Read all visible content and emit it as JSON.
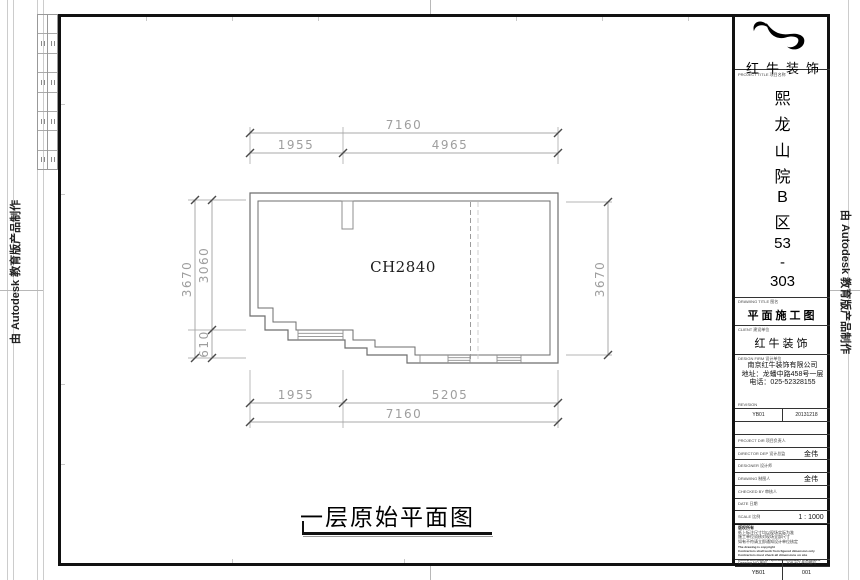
{
  "page": {
    "edge_stamp": "由 Autodesk 教育版产品制作"
  },
  "plan": {
    "room_label": "CH2840",
    "caption": "一层原始平面图",
    "dims": {
      "top_total": "7160",
      "top_left": "1955",
      "top_right": "4965",
      "bottom_left": "1955",
      "bottom_right": "5205",
      "bottom_total": "7160",
      "left_total": "3670",
      "left_upper": "3060",
      "left_lower": "610",
      "right_total": "3670"
    }
  },
  "titleblock": {
    "logo_name": "红牛装饰",
    "logo_sublabel": "PROJECT TITLE 项目名称",
    "project_chars": [
      "熙",
      "龙",
      "山",
      "院",
      "B",
      "区",
      "53",
      "-",
      "303"
    ],
    "drawing_title": {
      "label": "DRAWING TITLE 图名",
      "value": "平面施工图"
    },
    "client": {
      "label": "CLIENT 建设单位",
      "value": "红牛装饰"
    },
    "firm": {
      "label": "DESIGN FIRM 设计单位",
      "line1": "南京红牛装饰有限公司",
      "line2": "地址：龙蟠中路458号一层",
      "line3": "电话：025-52328155",
      "revision_label": "REVISION"
    },
    "revision_row": {
      "code": "YB01",
      "date": "20131218"
    },
    "personnel": [
      {
        "label": "PROJECT DIR 项目负责人",
        "value": ""
      },
      {
        "label": "DIRECTOR DEP 设计总监",
        "value": "金伟"
      },
      {
        "label": "DESIGNER 设计师",
        "value": ""
      },
      {
        "label": "DRAWING 制图人",
        "value": "金伟"
      },
      {
        "label": "CHECKED BY 审核人",
        "value": ""
      },
      {
        "label": "DATE 日期",
        "value": ""
      },
      {
        "label": "SCALE 比例",
        "value": "1 : 1000"
      }
    ],
    "notes": {
      "title": "版权所有",
      "zh1": "纸上标注尺寸均以现场实际为准",
      "zh2": "施工单位须核对现场全部尺寸",
      "zh3": "如有不符请立即通知设计单位核定",
      "en1": "The drawing is copyright",
      "en2": "Contractors shall work from figured dimension only",
      "en3": "Contractors must check all dimensions on site",
      "en4": "Contractors must be reported immediately to architects"
    },
    "footer": {
      "drawing_no_label": "Drawing NO 图号",
      "drawing_no": "YB01",
      "job_no_label": "JOB NO 合同编号",
      "job_no": "001"
    }
  }
}
